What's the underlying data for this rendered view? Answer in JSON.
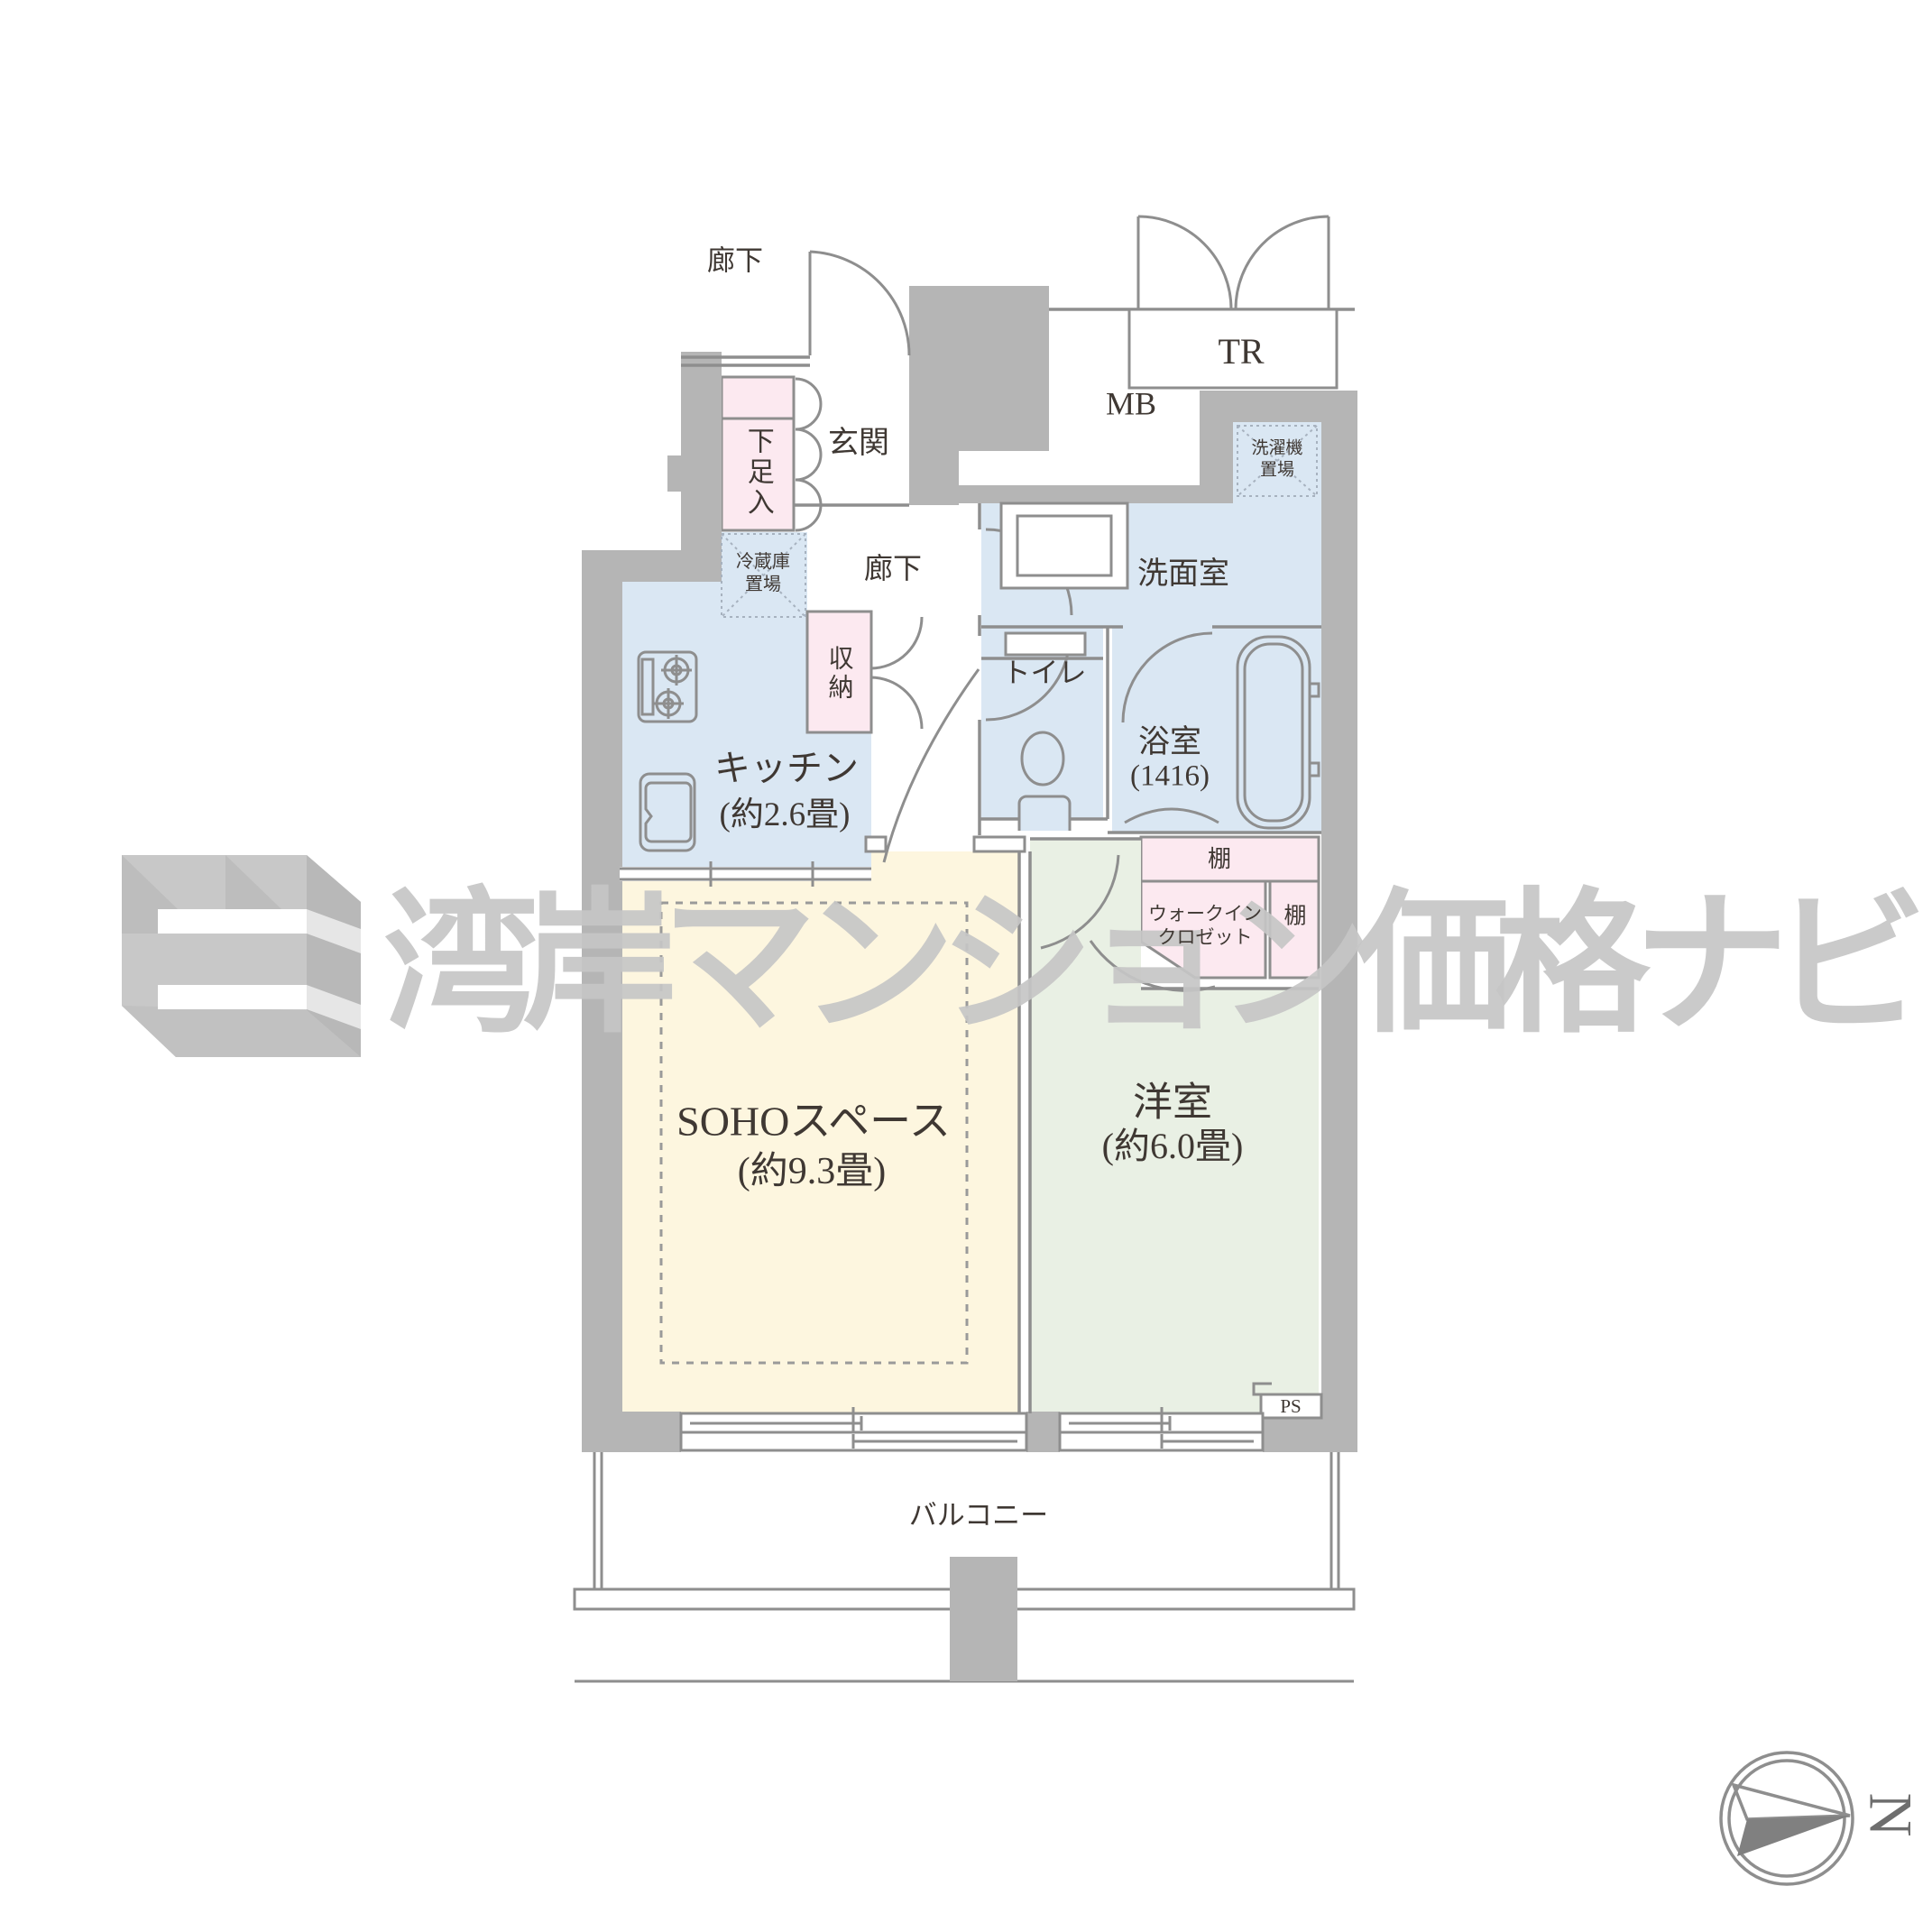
{
  "title": "apartment floor plan",
  "watermark": {
    "text": "湾岸マンション価格ナビ"
  },
  "compass": {
    "north": "N"
  },
  "labels": {
    "corridor_top": "廊下",
    "entrance": "玄関",
    "shoe_cabinet": "下足入",
    "trunk_room": "TR",
    "meter_box": "MB",
    "corridor_inner": "廊下",
    "fridge_line1": "冷蔵庫",
    "fridge_line2": "置場",
    "storage": "収納",
    "kitchen_name": "キッチン",
    "kitchen_size": "(約2.6畳)",
    "washroom": "洗面室",
    "washer_line1": "洗濯機",
    "washer_line2": "置場",
    "toilet": "トイレ",
    "bath_name": "浴室",
    "bath_size": "(1416)",
    "shelf_top": "棚",
    "shelf_side": "棚",
    "wic_line1": "ウォークイン",
    "wic_line2": "クロゼット",
    "soho_name": "SOHOスペース",
    "soho_size": "(約9.3畳)",
    "western_name": "洋室",
    "western_size": "(約6.0畳)",
    "ps": "PS",
    "balcony": "バルコニー"
  },
  "colors": {
    "wall": "#b5b5b5",
    "line": "#8e8e8e",
    "room_blue": "#dae7f3",
    "room_pink": "#fce9f0",
    "room_cream": "#fdf6df",
    "room_green": "#e9f0e4",
    "watermark": "#c6c6c6",
    "text": "#3f3833"
  }
}
